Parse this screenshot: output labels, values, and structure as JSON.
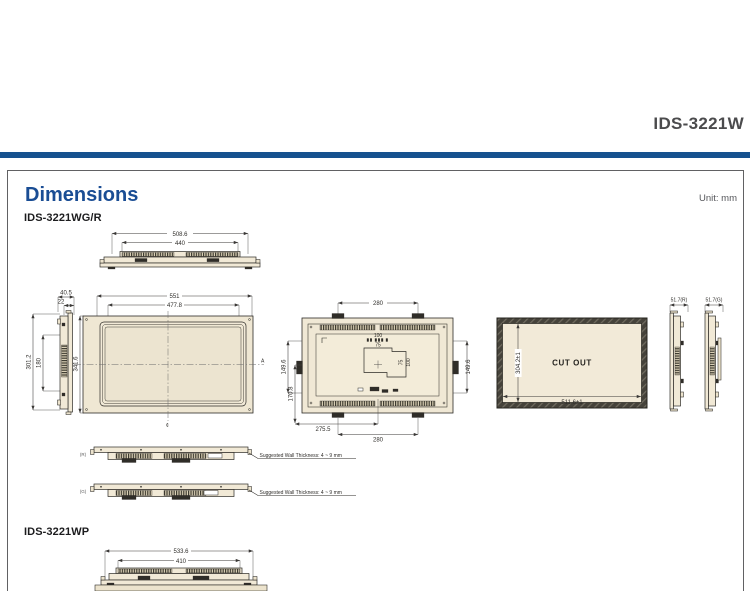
{
  "header": {
    "product": "IDS-3221W"
  },
  "section": {
    "title": "Dimensions",
    "unit": "Unit: mm",
    "model_wgr": "IDS-3221WG/R",
    "model_wp": "IDS-3221WP"
  },
  "dims": {
    "top_profile": {
      "outer": "508.6",
      "inner": "440"
    },
    "side_view": {
      "depth": "40.5",
      "bezel": "22",
      "outer_h": "301.2",
      "inner_h": "180"
    },
    "front_view": {
      "outer_w": "551",
      "inner_w": "477.8",
      "outer_h": "341.6",
      "inner_h": "269.5",
      "section_label": "A",
      "centerline_symbol": "¢"
    },
    "rear_view": {
      "mount_top_w": "280",
      "mount_left_h": "149.6",
      "mount_left_h2": "170.8",
      "mount_right_h": "149.6",
      "vesa_w_100": "100",
      "vesa_w_75": "75",
      "vesa_h_75": "75",
      "vesa_h_100": "100",
      "bottom_w1": "275.5",
      "bottom_w2": "280"
    },
    "cutout": {
      "label": "CUT OUT",
      "width": "511.6±1",
      "height": "304.2±1"
    },
    "side_r_label": "51.7(R)",
    "side_g_label": "51.7(G)",
    "wall_r": {
      "tag": "(R)",
      "note": "Suggested Wall Thickness: 4 ~ 9 mm"
    },
    "wall_g": {
      "tag": "(G)",
      "note": "Suggested Wall Thickness: 4 ~ 9 mm"
    },
    "wp_profile": {
      "outer": "533.6",
      "inner": "410"
    }
  },
  "colors": {
    "accent_blue": "#1a4d94",
    "rule_blue": "#16528f",
    "panel_beige": "#f1e9d6",
    "title_gray": "#4b4b4d"
  }
}
